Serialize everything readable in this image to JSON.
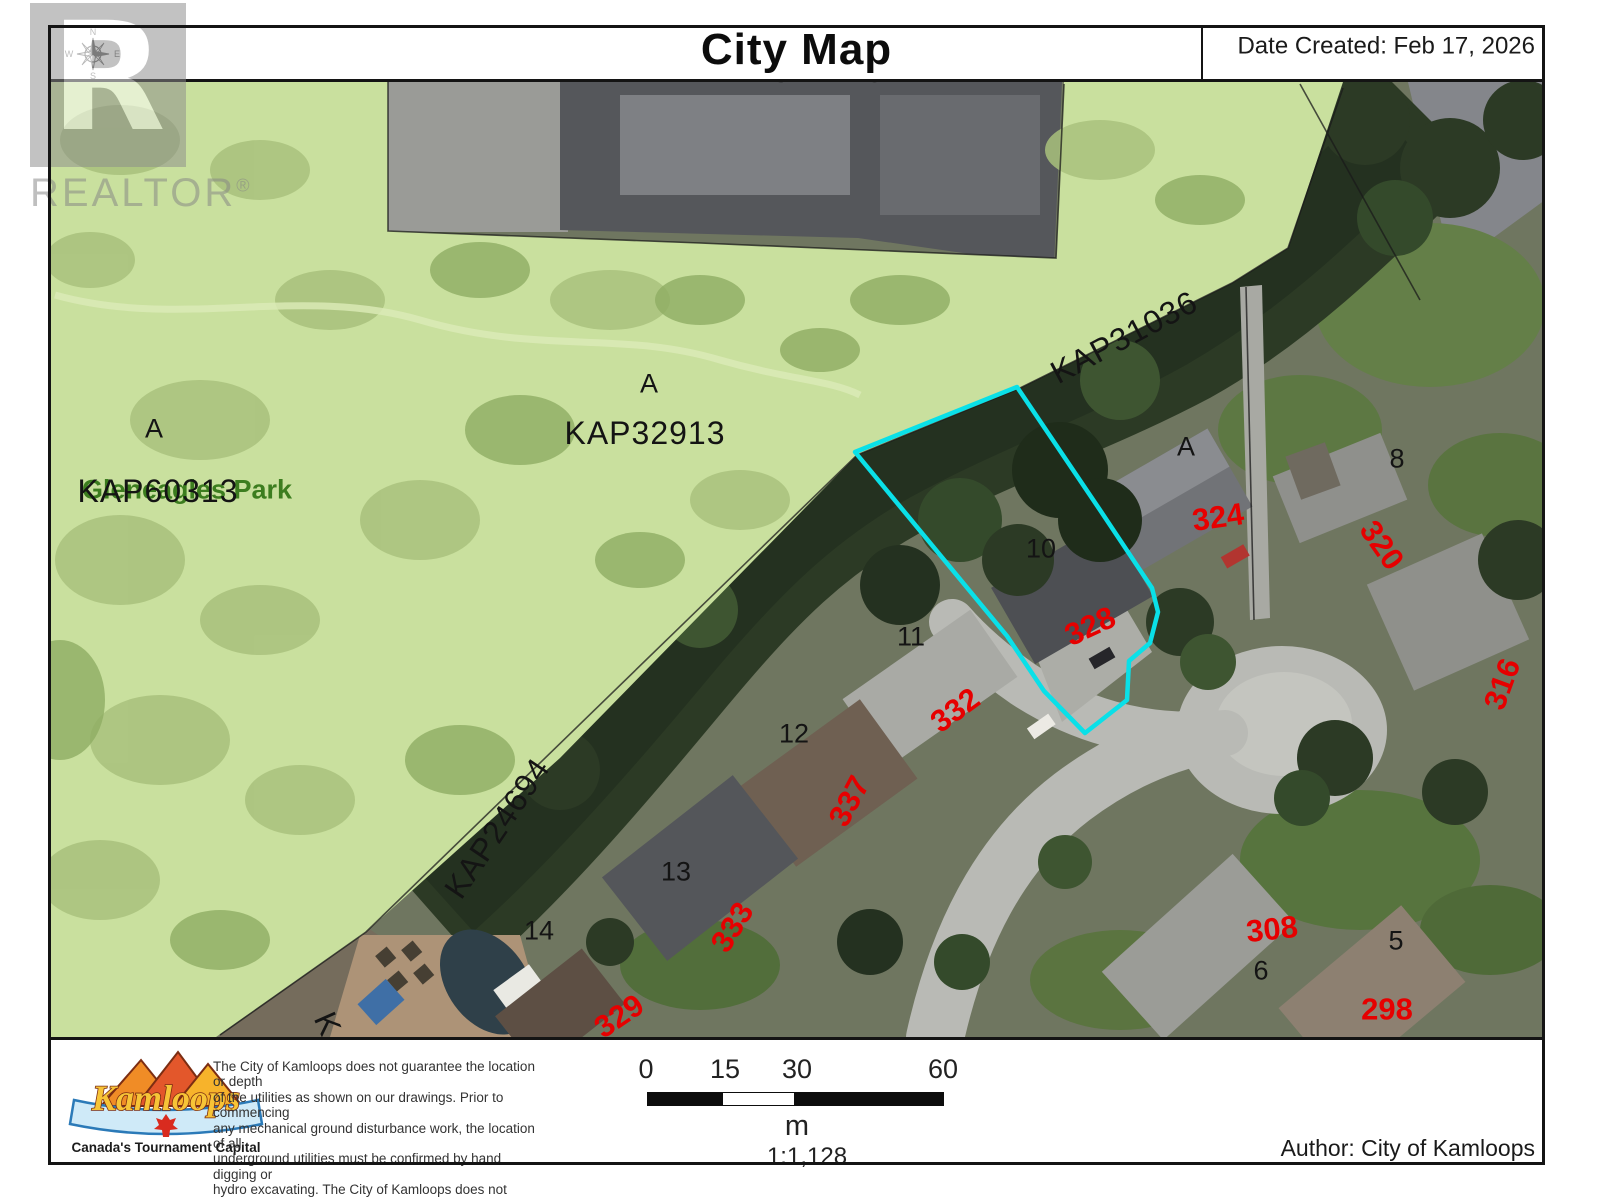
{
  "header": {
    "title": "City Map",
    "date_created": "Date Created: Feb 17, 2026"
  },
  "watermark": {
    "logo_letter": "R",
    "brand": "REALTOR",
    "registered": "®"
  },
  "compass": {
    "north": "N",
    "east": "E",
    "south": "S",
    "west": "W"
  },
  "map": {
    "highlight_color": "#0ae0e8",
    "house_number_color": "#e60000",
    "park_name_color": "#3c7d1f",
    "labels": [
      {
        "text": "322148",
        "x": 828,
        "y": 71,
        "rot": 0,
        "kind": "kap"
      },
      {
        "text": "Gleneagles Park",
        "x": 187,
        "y": 490,
        "rot": 0,
        "kind": "park"
      },
      {
        "text": "KAP60313",
        "x": 158,
        "y": 491,
        "rot": 0,
        "kind": "kap"
      },
      {
        "text": "A",
        "x": 154,
        "y": 429,
        "rot": 0,
        "kind": "lot"
      },
      {
        "text": "KAP32913",
        "x": 645,
        "y": 433,
        "rot": 0,
        "kind": "kap"
      },
      {
        "text": "A",
        "x": 649,
        "y": 384,
        "rot": 0,
        "kind": "lot"
      },
      {
        "text": "KAP31036",
        "x": 1124,
        "y": 337,
        "rot": -28,
        "kind": "kap"
      },
      {
        "text": "KAP24694",
        "x": 497,
        "y": 828,
        "rot": -56,
        "kind": "kap"
      },
      {
        "text": "K",
        "x": 328,
        "y": 1024,
        "rot": 66,
        "kind": "kap"
      },
      {
        "text": "A",
        "x": 1186,
        "y": 447,
        "rot": 0,
        "kind": "lot"
      },
      {
        "text": "8",
        "x": 1397,
        "y": 459,
        "rot": 0,
        "kind": "lot"
      },
      {
        "text": "10",
        "x": 1041,
        "y": 549,
        "rot": 0,
        "kind": "lot"
      },
      {
        "text": "11",
        "x": 911,
        "y": 637,
        "rot": 0,
        "kind": "lot"
      },
      {
        "text": "12",
        "x": 794,
        "y": 734,
        "rot": 0,
        "kind": "lot"
      },
      {
        "text": "13",
        "x": 676,
        "y": 872,
        "rot": 0,
        "kind": "lot"
      },
      {
        "text": "14",
        "x": 539,
        "y": 931,
        "rot": 0,
        "kind": "lot"
      },
      {
        "text": "5",
        "x": 1396,
        "y": 941,
        "rot": 0,
        "kind": "lot"
      },
      {
        "text": "6",
        "x": 1261,
        "y": 971,
        "rot": 0,
        "kind": "lot"
      },
      {
        "text": "324",
        "x": 1218,
        "y": 517,
        "rot": -8,
        "kind": "house"
      },
      {
        "text": "320",
        "x": 1382,
        "y": 545,
        "rot": 55,
        "kind": "house"
      },
      {
        "text": "328",
        "x": 1090,
        "y": 626,
        "rot": -25,
        "kind": "house"
      },
      {
        "text": "332",
        "x": 955,
        "y": 710,
        "rot": -36,
        "kind": "house"
      },
      {
        "text": "337",
        "x": 849,
        "y": 801,
        "rot": -62,
        "kind": "house"
      },
      {
        "text": "333",
        "x": 732,
        "y": 927,
        "rot": -58,
        "kind": "house"
      },
      {
        "text": "329",
        "x": 619,
        "y": 1016,
        "rot": -34,
        "kind": "house"
      },
      {
        "text": "316",
        "x": 1502,
        "y": 684,
        "rot": -70,
        "kind": "house"
      },
      {
        "text": "308",
        "x": 1272,
        "y": 929,
        "rot": -6,
        "kind": "house"
      },
      {
        "text": "298",
        "x": 1387,
        "y": 1009,
        "rot": 0,
        "kind": "house"
      }
    ]
  },
  "footer": {
    "logo_name": "Kamloops",
    "logo_tagline": "Canada's Tournament Capital",
    "disclaimer_lines": [
      "The City of Kamloops does not guarantee the location or depth",
      "of the utilities as shown on our drawings. Prior to commencing",
      "any mechanical ground disturbance work, the location of all",
      "underground utilities must be confirmed by hand digging or",
      "hydro excavating. The City of Kamloops does not accept any",
      "liability or responsibility for errors or omissions."
    ],
    "scale": {
      "ticks": [
        "0",
        "15",
        "30",
        "60"
      ],
      "unit": "m",
      "ratio": "1:1,128"
    },
    "author": "Author: City of Kamloops"
  }
}
